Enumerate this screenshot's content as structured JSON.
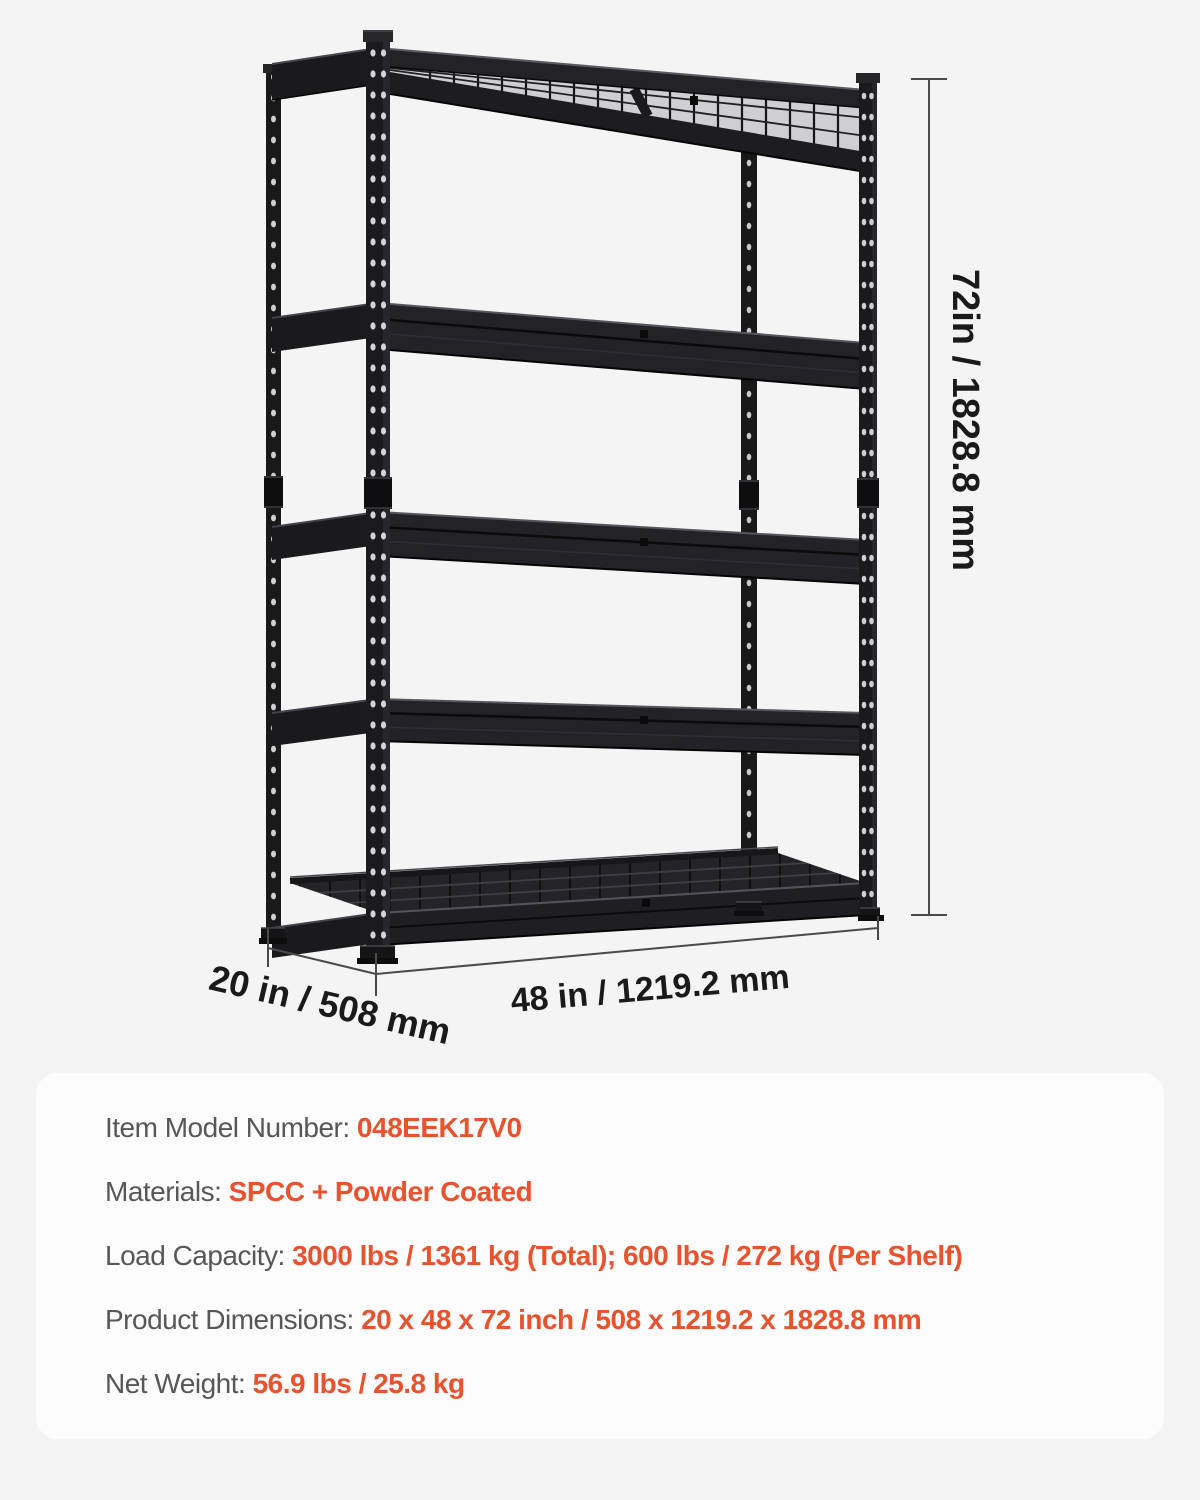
{
  "page": {
    "background_color": "#f4f4f5",
    "panel_color": "#fcfcfd",
    "accent_color": "#e8522c",
    "label_color": "#57575a",
    "shelf_color": "#1b1b1e"
  },
  "illustration": {
    "description": "5-tier black boltless storage shelving unit with wire mesh decks",
    "height_label": "72in / 1828.8 mm",
    "depth_label": "20 in / 508 mm",
    "width_label": "48 in / 1219.2 mm"
  },
  "specs": {
    "rows": [
      {
        "label": "Item Model Number: ",
        "value": "048EEK17V0"
      },
      {
        "label": "Materials: ",
        "value": "SPCC + Powder Coated"
      },
      {
        "label": "Load Capacity: ",
        "value": "3000 lbs / 1361 kg (Total); 600 lbs / 272 kg (Per Shelf)"
      },
      {
        "label": "Product Dimensions: ",
        "value": "20 x 48 x 72 inch / 508 x 1219.2 x 1828.8 mm"
      },
      {
        "label": "Net Weight: ",
        "value": "56.9 lbs / 25.8 kg"
      }
    ]
  }
}
